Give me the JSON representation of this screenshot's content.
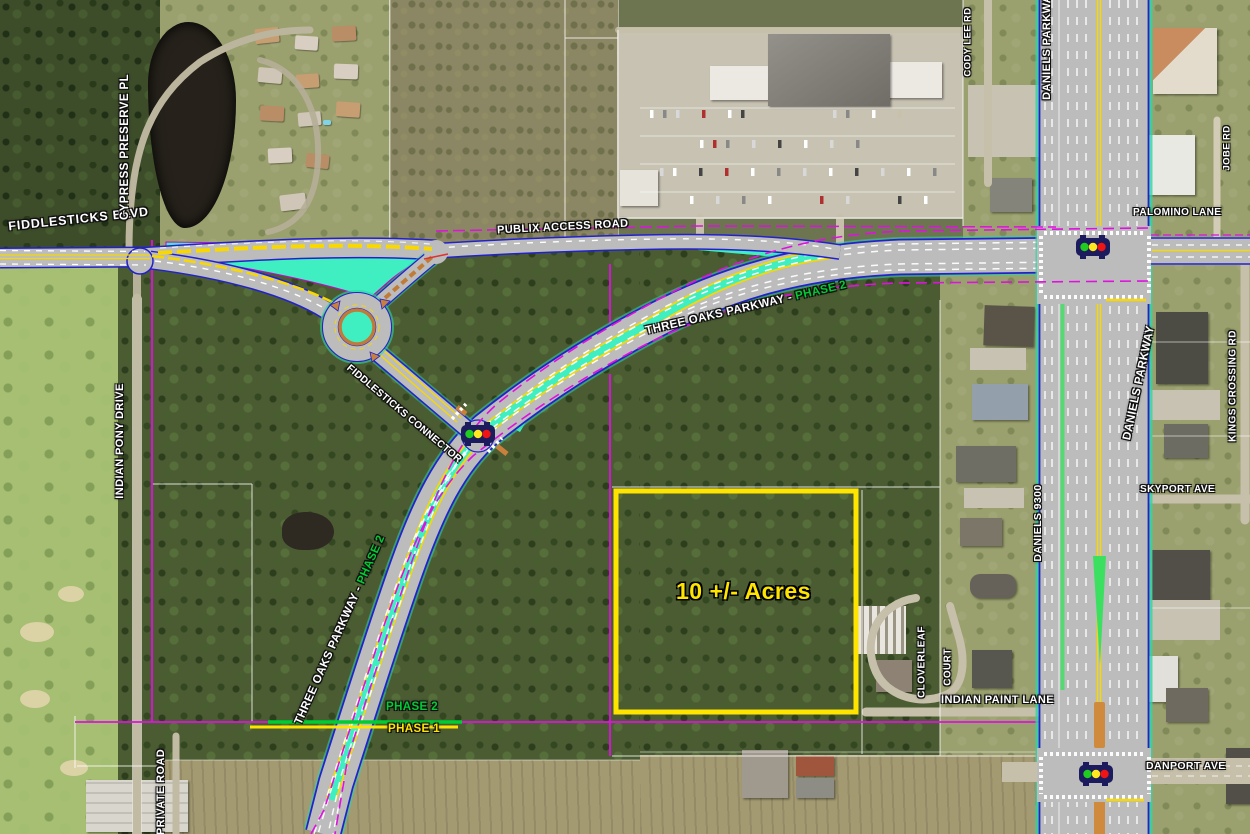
{
  "map": {
    "parcel": {
      "acreage": "10 +/- Acres",
      "outline_color": "#FFE400"
    },
    "phase_markers": {
      "phase1": "PHASE 1",
      "phase2": "PHASE 2",
      "phase1_color": "#FFE400",
      "phase2_color": "#00CC33"
    },
    "road_labels": {
      "fiddlesticks_blvd": "FIDDLESTICKS BLVD",
      "cypress_preserve_pl": "CYPRESS PRESERVE PL",
      "publix_access_road": "PUBLIX ACCESS ROAD",
      "three_oaks_parkway_name": "THREE OAKS PARKWAY -",
      "three_oaks_parkway_phase": "PHASE 2",
      "fiddlesticks_connector": "FIDDLESTICKS CONNECTOR",
      "indian_pony_drive": "INDIAN PONY DRIVE",
      "private_road": "PRIVATE ROAD",
      "cody_lee_rd": "CODY LEE RD",
      "daniels_parkway_top": "DANIELS PARKWAY",
      "daniels_parkway_mid": "DANIELS PARKWAY",
      "jobe_rd": "JOBE RD",
      "palomino_lane": "PALOMINO LANE",
      "kings_crossing_rd": "KINGS CROSSING RD",
      "daniels_9300": "DANIELS 9300",
      "skyport_ave": "SKYPORT AVE",
      "cloverleaf": "CLOVERLEAF",
      "court": "COURT",
      "indian_paint_lane": "INDIAN PAINT LANE",
      "danport_ave": "DANPORT AVE"
    },
    "icons": {
      "traffic_signal": "red-yellow-green-lights"
    },
    "legend_colors": {
      "median_landscape": "#3FEFC2",
      "verge_green": "#3BE060",
      "right_of_way_line": "#E010E0",
      "road_casing_blue": "#2222CC",
      "lane_stripe_yellow": "#F8D800",
      "curb_orange": "#C07B38",
      "signal_green": "#1FCC1F",
      "signal_yellow": "#FFE81F",
      "signal_red": "#F01414"
    }
  }
}
